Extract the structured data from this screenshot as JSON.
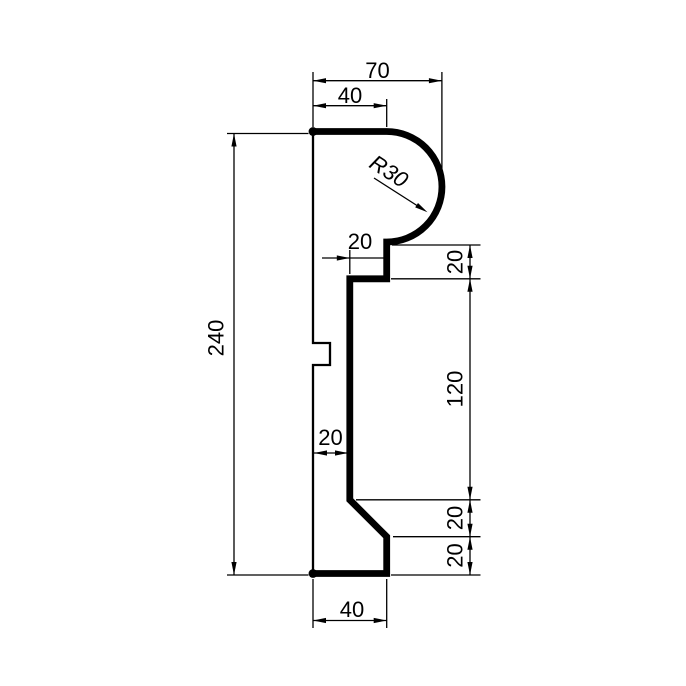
{
  "drawing": {
    "type": "profile-section",
    "description": "Technical 2D dimensioned drawing of a molding cross-section profile",
    "units_shown": false
  },
  "colors": {
    "ink": "#000000",
    "paper": "#ffffff"
  },
  "dimensions": {
    "top_overall_width": "70",
    "top_flat_width": "40",
    "nose_radius": "R30",
    "neck_step_width": "20",
    "neck_height": "20",
    "overall_height": "240",
    "web_height": "120",
    "wall_thickness": "20",
    "chamfer_height": "20",
    "base_height": "20",
    "bottom_width": "40"
  }
}
